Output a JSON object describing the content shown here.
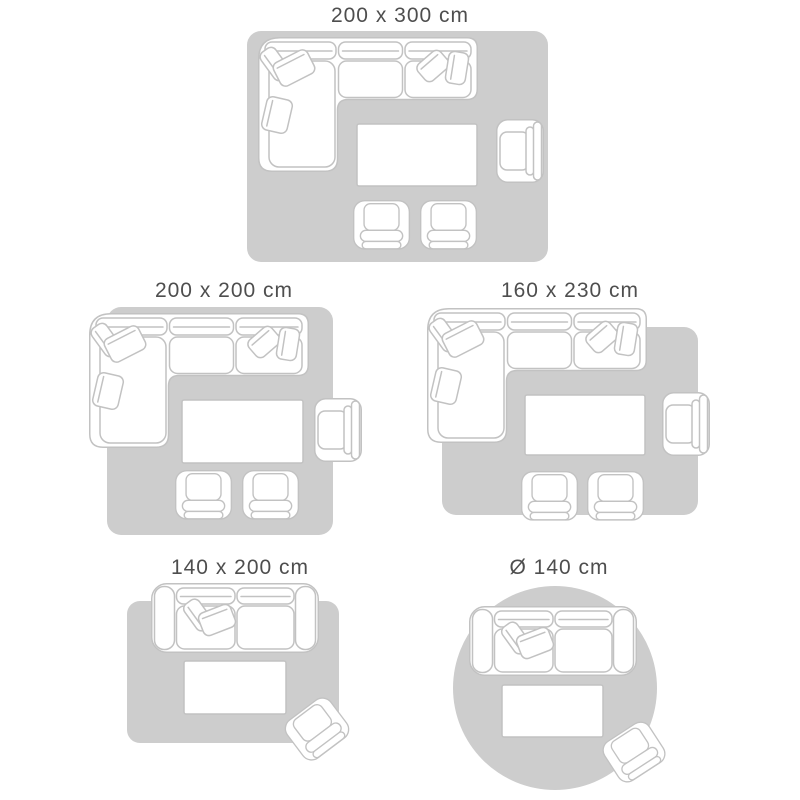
{
  "title": "Rug size guide with living room furniture layouts",
  "colors": {
    "background": "#ffffff",
    "rug_fill": "#cdcdcd",
    "furniture_outline": "#c2c2c2",
    "furniture_fill": "#ffffff",
    "label_text": "#4e4e4e"
  },
  "panels": [
    {
      "label": "200 x 300 cm",
      "rug_shape": "rectangle",
      "furniture_icons": [
        "corner-sofa-icon",
        "coffee-table-icon",
        "armchair-icon",
        "footstool-chair-icon",
        "footstool-chair-icon"
      ]
    },
    {
      "label": "200 x 200 cm",
      "rug_shape": "rectangle",
      "furniture_icons": [
        "corner-sofa-icon",
        "coffee-table-icon",
        "armchair-icon",
        "footstool-chair-icon",
        "footstool-chair-icon"
      ]
    },
    {
      "label": "160 x 230 cm",
      "rug_shape": "rectangle",
      "furniture_icons": [
        "corner-sofa-icon",
        "coffee-table-icon",
        "armchair-icon",
        "footstool-chair-icon",
        "footstool-chair-icon"
      ]
    },
    {
      "label": "140 x 200 cm",
      "rug_shape": "rectangle",
      "furniture_icons": [
        "two-seater-sofa-icon",
        "coffee-table-icon",
        "armchair-icon"
      ]
    },
    {
      "label": "Ø 140 cm",
      "rug_shape": "circle",
      "furniture_icons": [
        "two-seater-sofa-icon",
        "coffee-table-icon",
        "armchair-icon"
      ]
    }
  ]
}
